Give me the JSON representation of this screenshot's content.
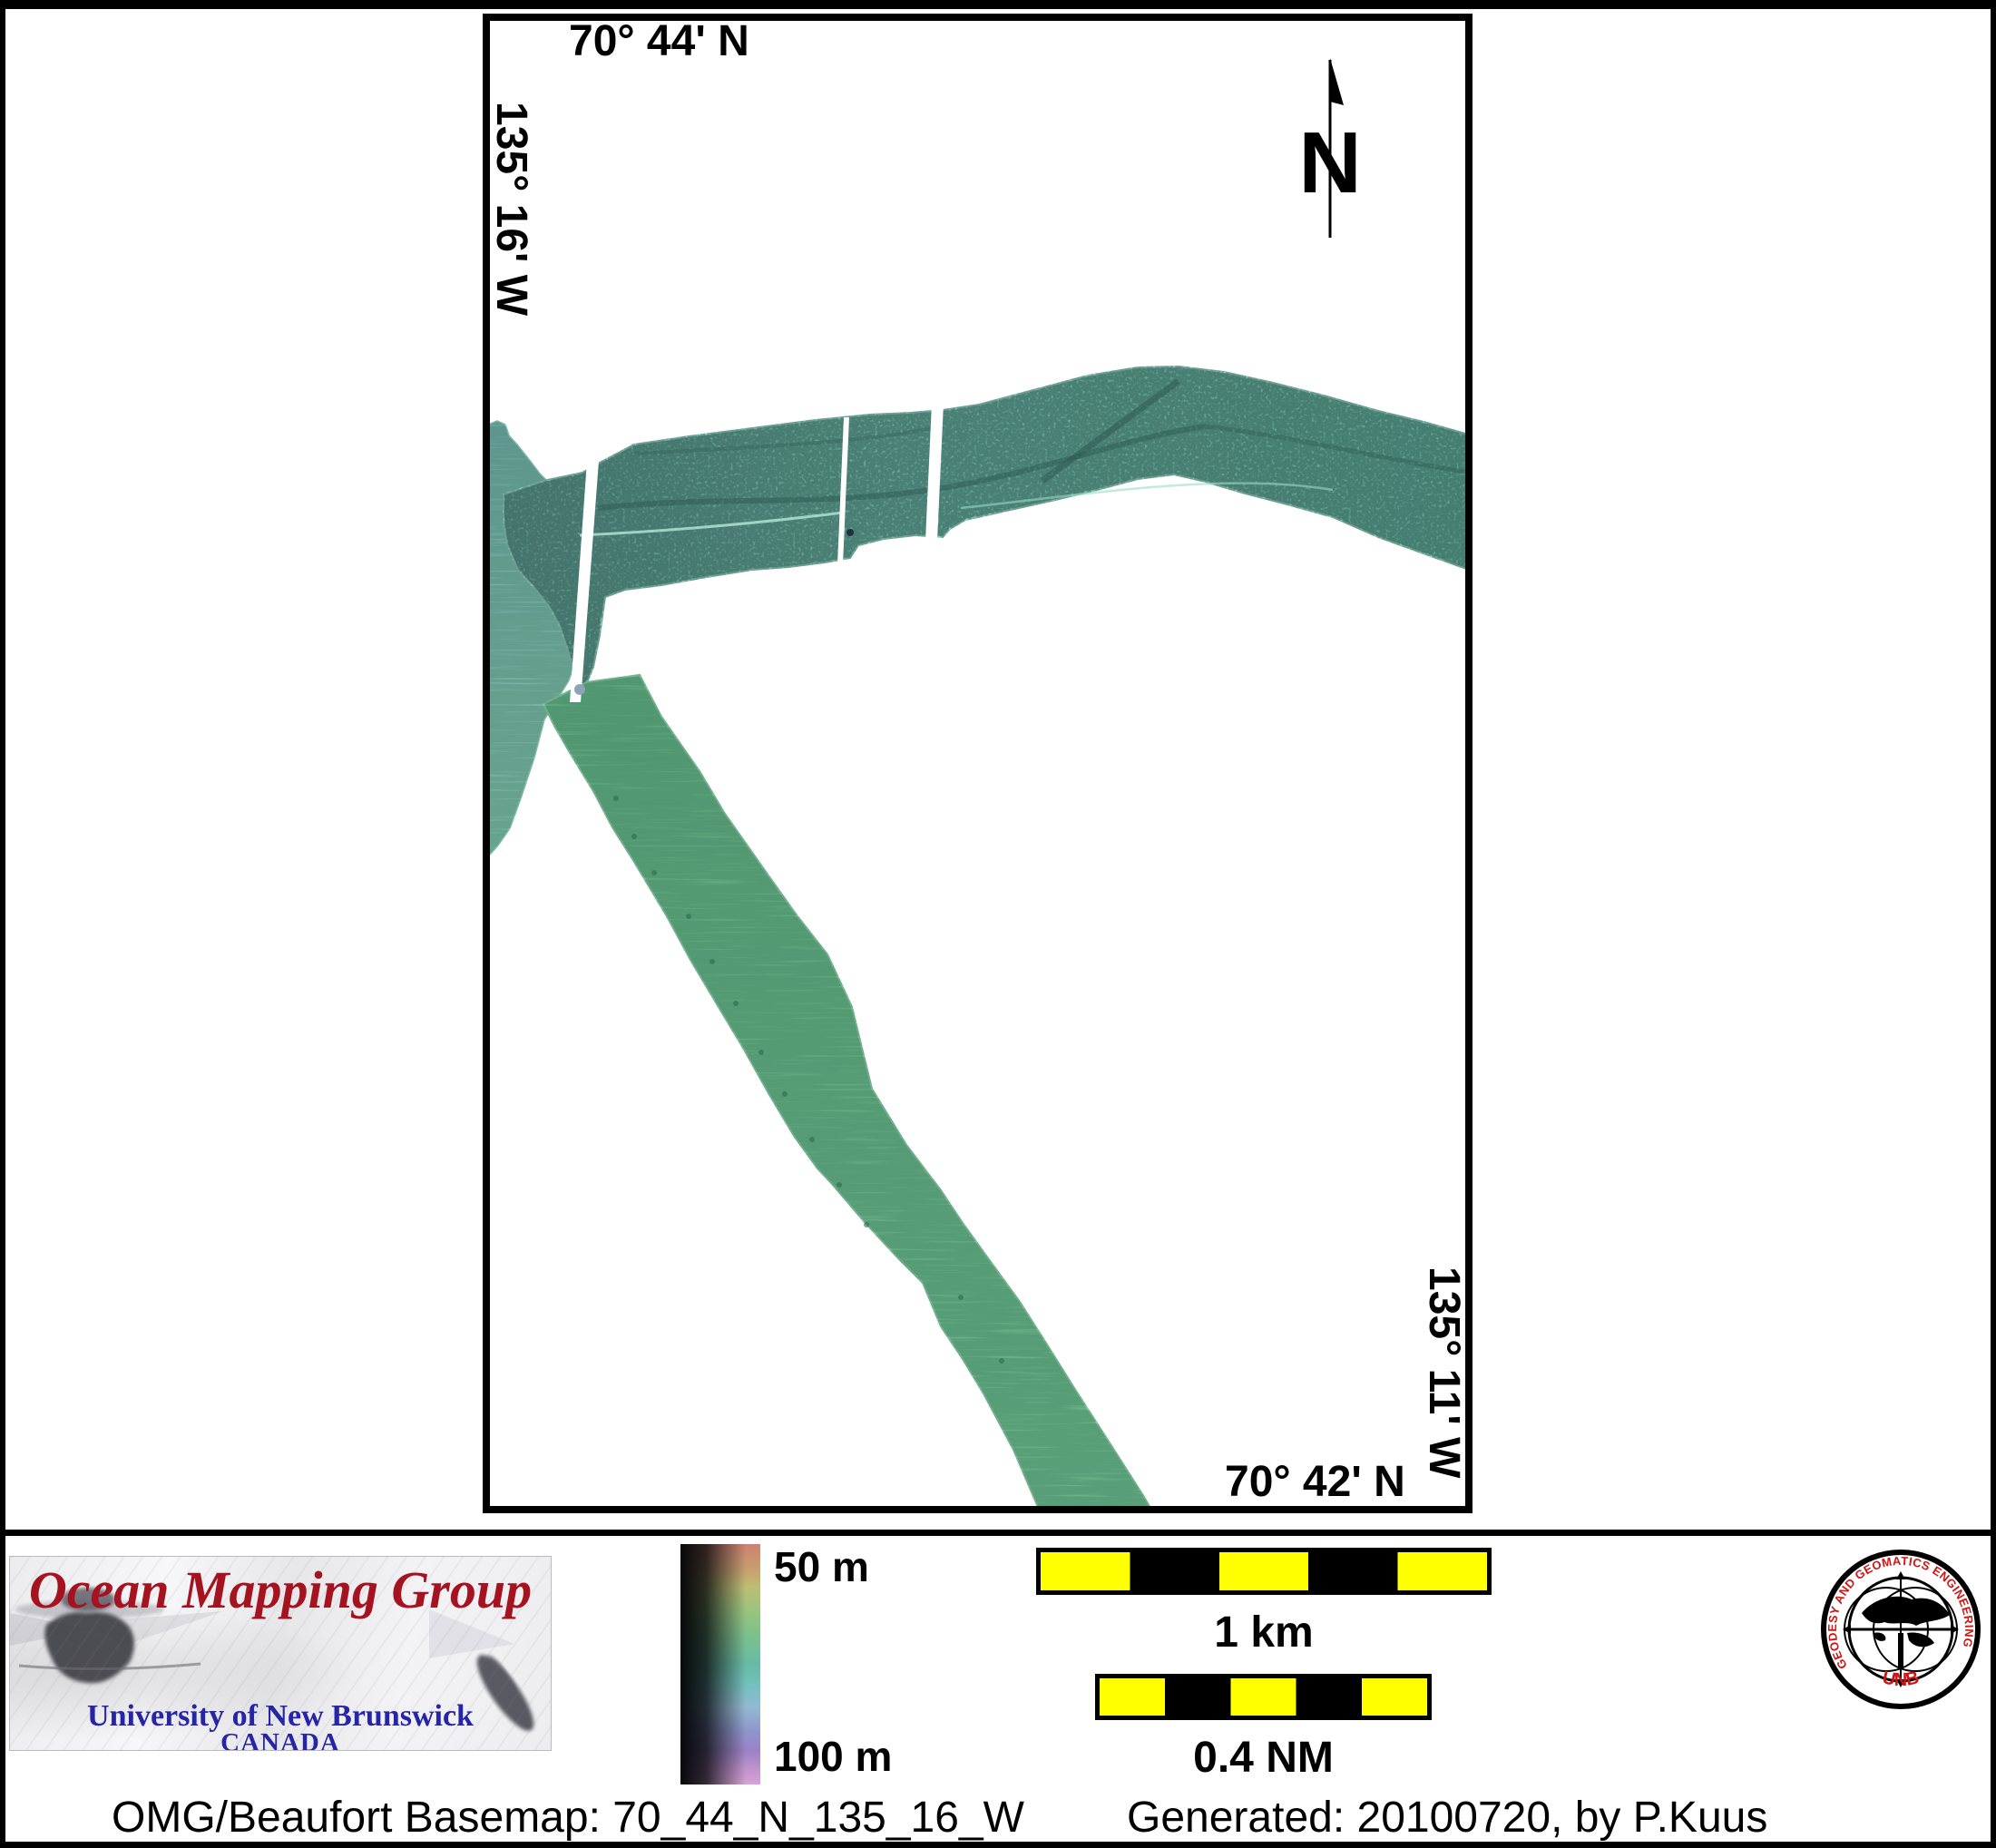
{
  "map": {
    "top_latitude": "70° 44' N",
    "left_longitude": "135° 16' W",
    "right_longitude": "135° 11' W",
    "bottom_latitude": "70° 42' N",
    "north_label": "N"
  },
  "depth_scale": {
    "top_label": "50 m",
    "bottom_label": "100 m"
  },
  "scale_bars": {
    "km": {
      "label": "1 km"
    },
    "nm": {
      "label": "0.4 NM"
    }
  },
  "omg_logo": {
    "title": "Ocean Mapping Group",
    "institution": "University of New Brunswick",
    "country": "CANADA"
  },
  "unb_seal": {
    "ring_text": "GEODESY AND GEOMATICS ENGINEERING",
    "label": "UNB"
  },
  "caption": {
    "basemap": "OMG/Beaufort Basemap: 70_44_N_135_16_W",
    "generated": "Generated: 20100720, by P.Kuus"
  },
  "colors": {
    "swath_teal": "#68a89b",
    "swath_green": "#64ad82",
    "swath_blob": "#78b0a8",
    "scalebar_yellow": "#ffff00",
    "logo_red": "#a51220",
    "logo_blue": "#2525a5",
    "seal_red": "#d01414"
  }
}
